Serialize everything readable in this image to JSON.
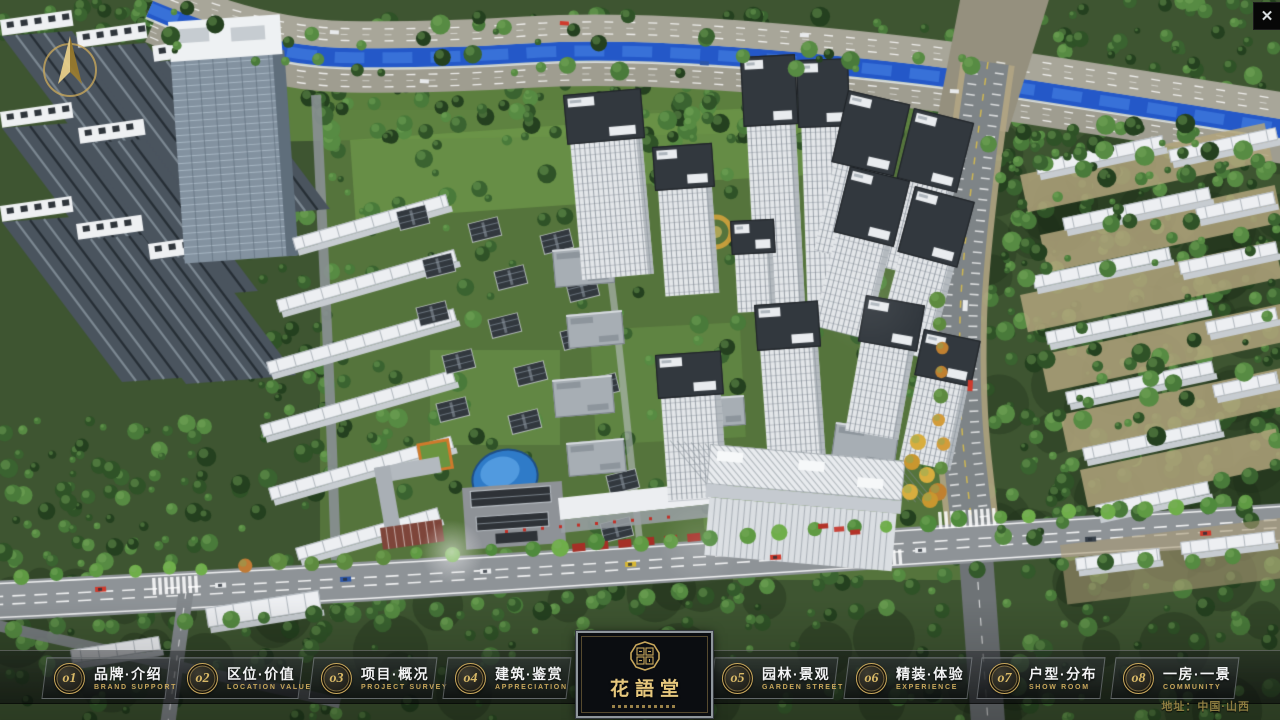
{
  "window": {
    "close_icon": "✕"
  },
  "nav": {
    "items": [
      {
        "num": "o1",
        "zh": "品牌·介绍",
        "en": "BRAND SUPPORT"
      },
      {
        "num": "o2",
        "zh": "区位·价值",
        "en": "LOCATION VALUE"
      },
      {
        "num": "o3",
        "zh": "项目·概况",
        "en": "PROJECT SURVEY"
      },
      {
        "num": "o4",
        "zh": "建筑·鉴赏",
        "en": "APPRECIATION"
      },
      {
        "num": "o5",
        "zh": "园林·景观",
        "en": "GARDEN STREET"
      },
      {
        "num": "o6",
        "zh": "精装·体验",
        "en": "EXPERIENCE"
      },
      {
        "num": "o7",
        "zh": "户型·分布",
        "en": "SHOW ROOM"
      },
      {
        "num": "o8",
        "zh": "一房·一景",
        "en": "COMMUNITY"
      }
    ]
  },
  "logo": {
    "title": "花語堂"
  },
  "footer": {
    "address": "地址：中国·山西"
  },
  "colors": {
    "gold": "#c9a85c",
    "river": "#2c63c9",
    "bar_bg": "rgba(12,14,17,0.55)"
  }
}
